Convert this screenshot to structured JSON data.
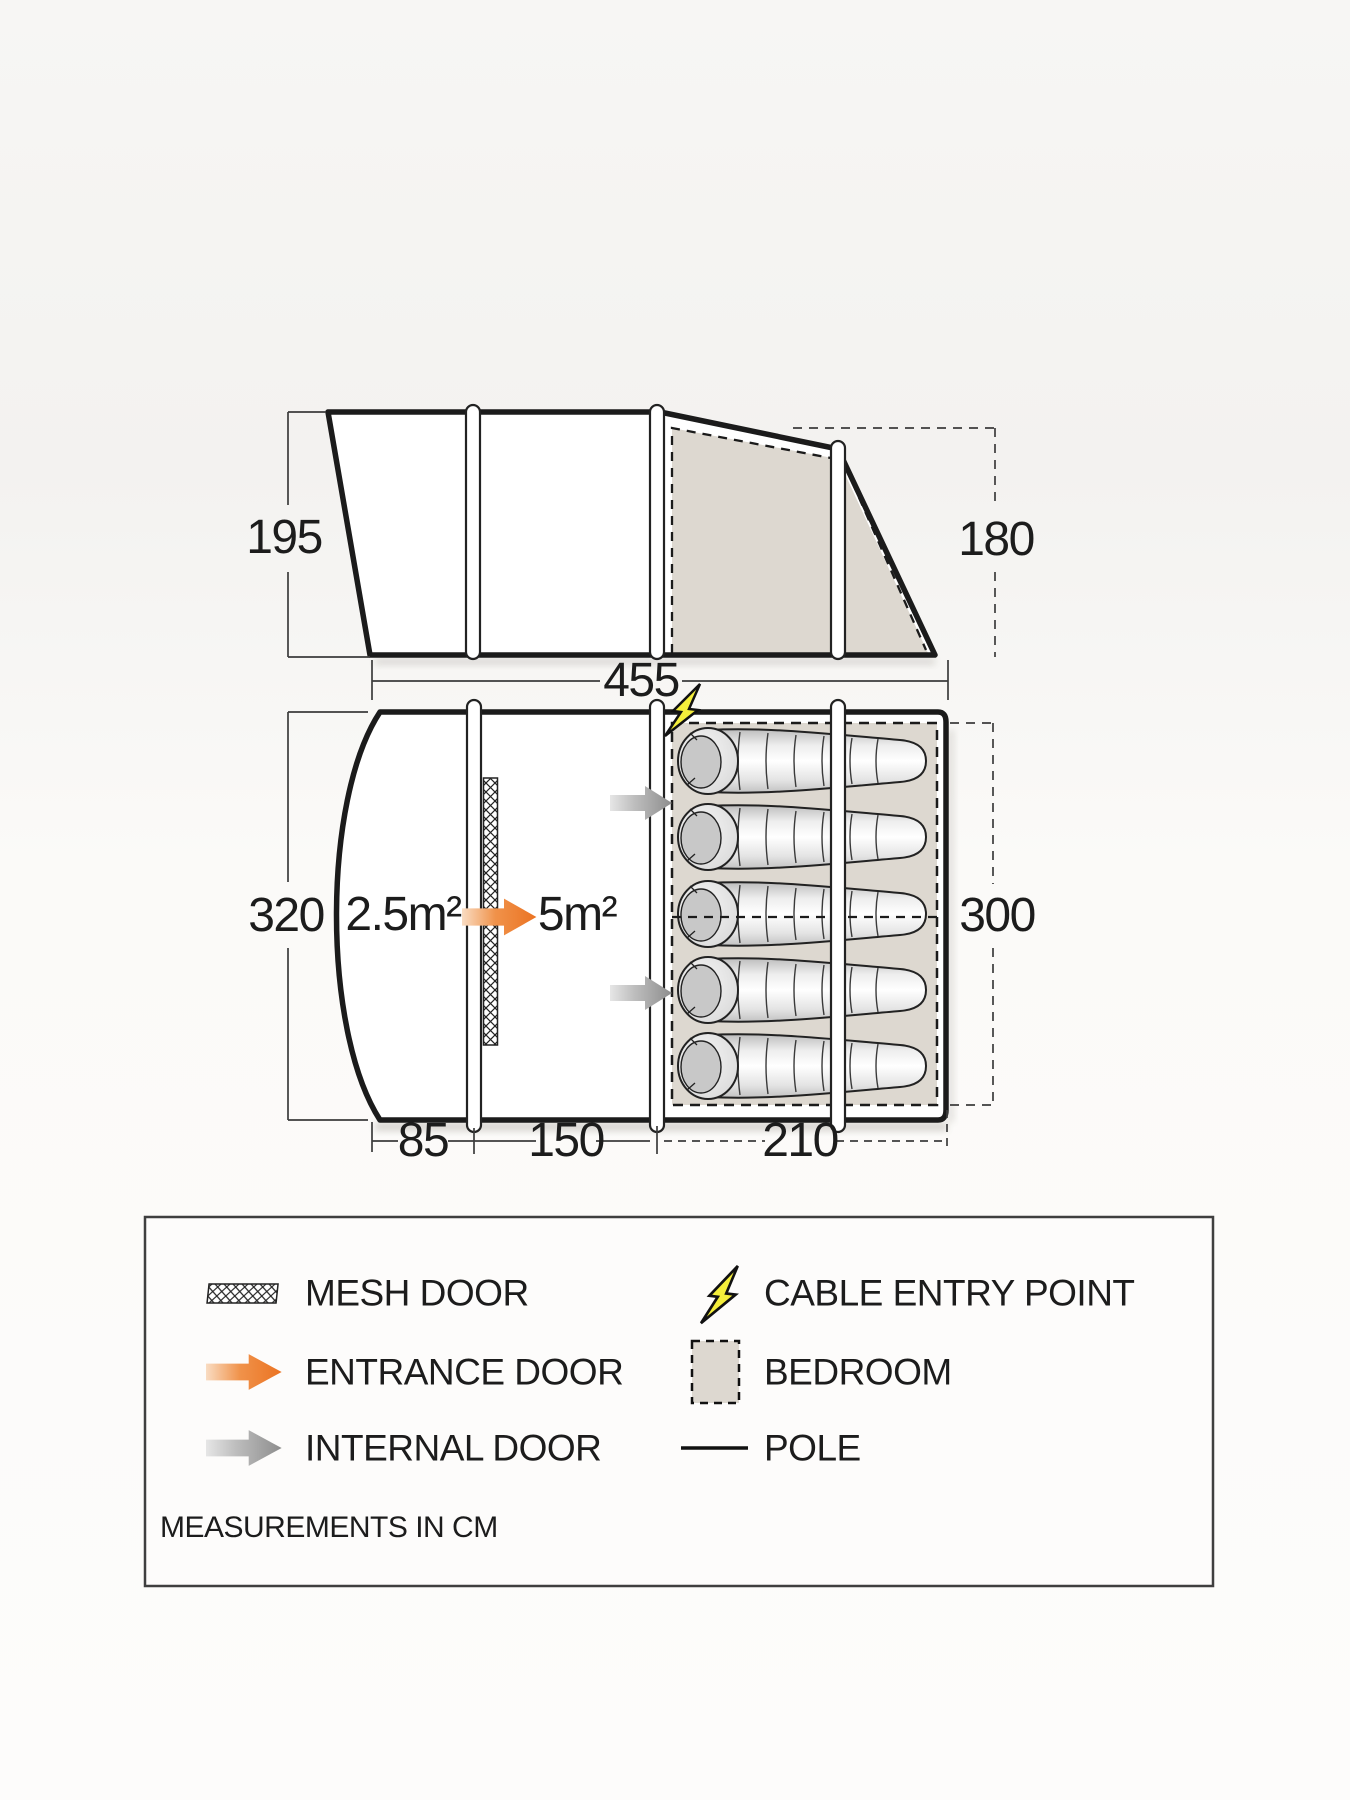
{
  "side_view": {
    "height_left": "195",
    "height_right": "180",
    "width": "455"
  },
  "floor_plan": {
    "total_depth": "320",
    "bedroom_depth": "300",
    "porch_area": "2.5m²",
    "living_area": "5m²",
    "porch_width": "85",
    "living_width": "150",
    "bedroom_width": "210",
    "sleeping_bag_count": 5
  },
  "legend": {
    "mesh_door": "MESH DOOR",
    "cable_entry": "CABLE ENTRY POINT",
    "entrance_door": "ENTRANCE DOOR",
    "bedroom": "BEDROOM",
    "internal_door": "INTERNAL DOOR",
    "pole": "POLE",
    "note": "MEASUREMENTS IN CM"
  },
  "icons": {
    "mesh": "mesh-door-icon",
    "bolt": "cable-entry-icon",
    "entrance_arrow": "entrance-door-icon",
    "bedroom_swatch": "bedroom-swatch-icon",
    "internal_arrow": "internal-door-icon",
    "pole_line": "pole-icon"
  },
  "colors": {
    "outline": "#1b1b1b",
    "bedroom_beige": "#ddd8d0",
    "entrance_orange": "#eb7322",
    "internal_gray": "#8d8d8d",
    "bolt_yellow": "#f4ee3b",
    "dimension_line": "#3c3c3c"
  }
}
